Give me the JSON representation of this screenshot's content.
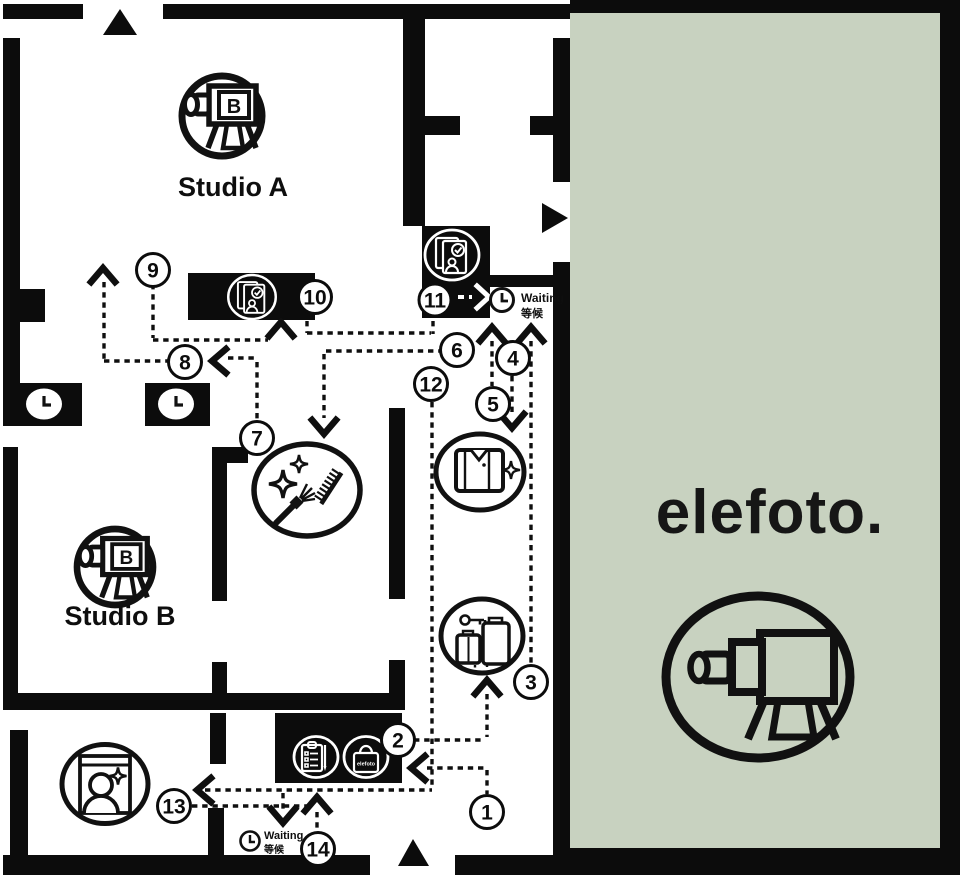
{
  "brand": {
    "wordmark": "elefoto.",
    "bag_label": "elefoto",
    "camera_letter": "B"
  },
  "rooms": {
    "studio_a": "Studio A",
    "studio_b": "Studio B"
  },
  "waiting_areas": {
    "top": {
      "en": "Waiting",
      "zh": "等候"
    },
    "bottom": {
      "en": "Waiting",
      "zh": "等候"
    }
  },
  "route_stops": [
    {
      "number": "1"
    },
    {
      "number": "2"
    },
    {
      "number": "3"
    },
    {
      "number": "4"
    },
    {
      "number": "5"
    },
    {
      "number": "6"
    },
    {
      "number": "7"
    },
    {
      "number": "8"
    },
    {
      "number": "9"
    },
    {
      "number": "10"
    },
    {
      "number": "11"
    },
    {
      "number": "12"
    },
    {
      "number": "13"
    },
    {
      "number": "14"
    }
  ],
  "icons": {
    "studio_camera": "camera-on-tripod",
    "brand_logo": "camera-on-tripod-oval",
    "photo_review": "photo-stack-with-check-and-portrait",
    "retouch": "portrait-frame-with-sparkle",
    "makeup": "brush-comb-sparkles",
    "wardrobe": "folded-polo-shirt-sparkle",
    "luggage": "suitcases-with-key",
    "checkin": "clipboard-with-pen",
    "purchase": "elefoto-shopping-bag",
    "waiting": "clock",
    "entrance": "triangle-arrow"
  },
  "colors": {
    "accent_green": "#c8d2c0",
    "wall": "#0c0c0c",
    "background": "#ffffff",
    "ink": "#111111"
  }
}
